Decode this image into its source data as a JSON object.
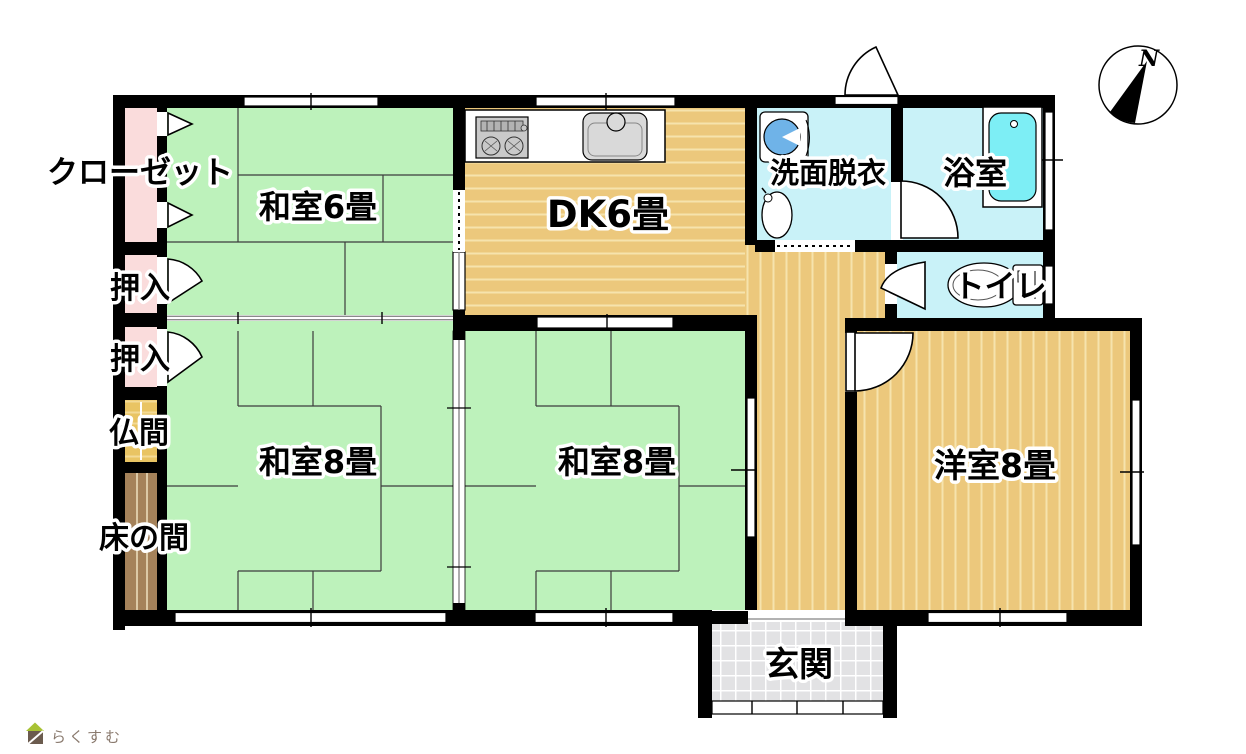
{
  "plan": {
    "rooms": {
      "closet": {
        "label": "クローゼット"
      },
      "washitsu6": {
        "label": "和室6畳"
      },
      "dk": {
        "label": "DK6畳"
      },
      "senmen": {
        "label": "洗面脱衣"
      },
      "bath": {
        "label": "浴室"
      },
      "toilet": {
        "label": "トイレ"
      },
      "oshiire1": {
        "label": "押入"
      },
      "oshiire2": {
        "label": "押入"
      },
      "butsuma": {
        "label": "仏間"
      },
      "tokonoma": {
        "label": "床の間"
      },
      "washitsu8a": {
        "label": "和室8畳"
      },
      "washitsu8b": {
        "label": "和室8畳"
      },
      "youshitsu8": {
        "label": "洋室8畳"
      },
      "genkan": {
        "label": "玄関"
      }
    },
    "compass": {
      "label": "N"
    },
    "logo": {
      "label": "らくすむ"
    },
    "colors": {
      "tatami": "#bdf2bb",
      "wood": "#ecc87c",
      "wood-line": "#f6e3ad",
      "pink": "#fadcdc",
      "wet": "#c9f2f8",
      "tub": "#7deef5",
      "machine": "#6fb3e8",
      "butsuma": "#e9c463",
      "butsuma-line": "#f3da96",
      "toko": "#a5825a",
      "toko-line": "#dcc9a6",
      "genkan": "#e2e2e4",
      "wall": "#000000",
      "logo-green": "#a8c234",
      "logo-brown": "#6b5b4e",
      "logo-text": "#8a7a6e"
    }
  }
}
